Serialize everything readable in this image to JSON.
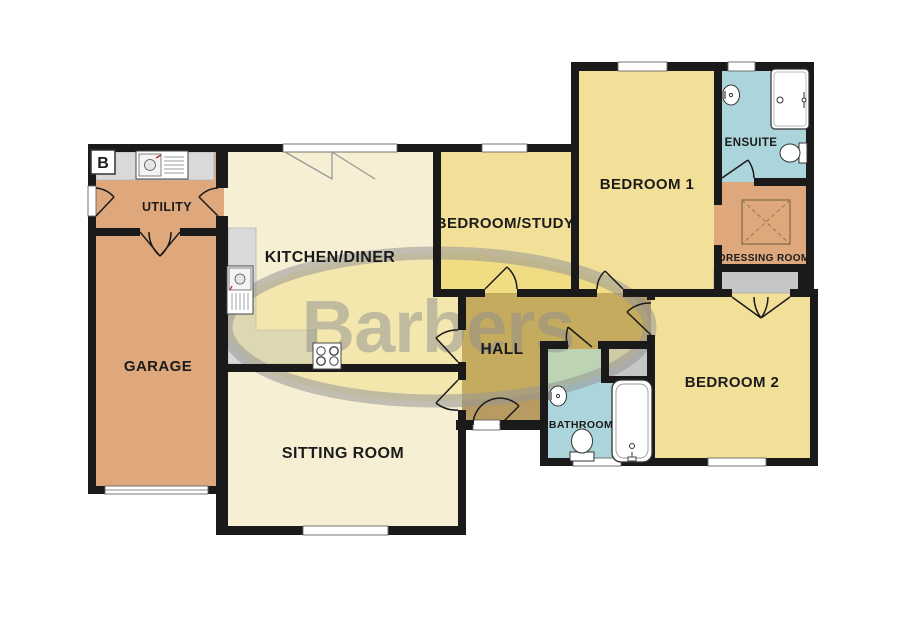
{
  "marker": {
    "label": "B"
  },
  "watermark": {
    "text": "Barbers"
  },
  "rooms": [
    {
      "id": "utility",
      "label": "UTILITY"
    },
    {
      "id": "garage",
      "label": "GARAGE"
    },
    {
      "id": "kitchen-diner",
      "label": "KITCHEN/DINER"
    },
    {
      "id": "sitting-room",
      "label": "SITTING ROOM"
    },
    {
      "id": "bedroom-study",
      "label": "BEDROOM/STUDY"
    },
    {
      "id": "hall",
      "label": "HALL"
    },
    {
      "id": "bedroom-1",
      "label": "BEDROOM 1"
    },
    {
      "id": "ensuite",
      "label": "ENSUITE"
    },
    {
      "id": "dressing-room",
      "label": "DRESSING ROOM"
    },
    {
      "id": "bedroom-2",
      "label": "BEDROOM 2"
    },
    {
      "id": "bathroom",
      "label": "BATHROOM"
    }
  ],
  "fixtures": [
    "utility-sink",
    "kitchen-sink",
    "hob",
    "shower",
    "ensuite-basin",
    "ensuite-toilet",
    "bathroom-basin",
    "bathroom-toilet",
    "bathtub",
    "dressing-wardrobe",
    "built-in-cupboard",
    "bedroom2-wardrobe"
  ],
  "colors": {
    "wall": "#1a1a1a",
    "tan": "#dfa87c",
    "cream": "#f7efd3",
    "yellow": "#f3e098",
    "blue": "#abd4db",
    "hall": "#b79b63",
    "cupboard": "#c6c6c6",
    "counter": "#d9d9d9",
    "label": "#1b1b1b",
    "watermark_yellow": "#e9d450",
    "watermark_gray": "#8f8f8f"
  }
}
